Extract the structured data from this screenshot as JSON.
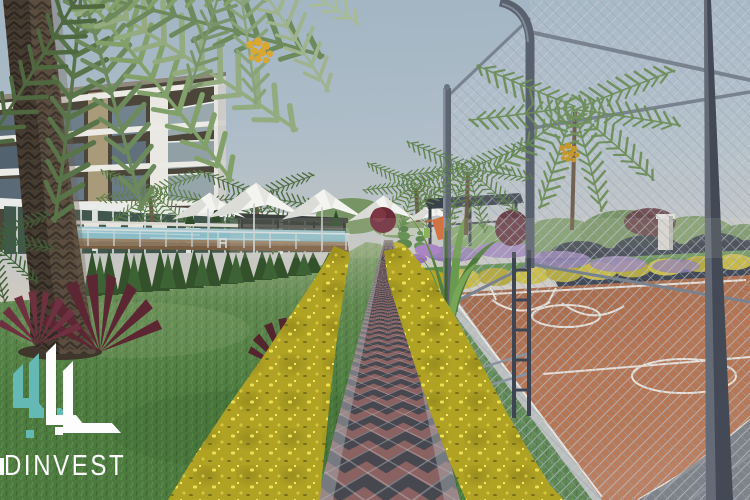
{
  "watermark": {
    "brand": "DINVEST"
  },
  "scene": {
    "description": "3D architectural rendering of a residential complex: apartment building with pool and canopy umbrellas on the left, a diamond-paved garden walkway lined with yellow flower hedges in the center, and a fenced basketball court with playground and pergola on the right."
  },
  "colors": {
    "sky_top": "#a2b5c3",
    "sky_horizon": "#dcd2c2",
    "lawn_green": "#4d7b3f",
    "walkway_slate": "#46474f",
    "walkway_mauve": "#8a6262",
    "flower_yellow": "#c9ba2f",
    "court_terracotta": "#b2673f",
    "court_line_white": "#f1eee8",
    "fence_gray": "#59616e",
    "pool_water": "#79b2bf",
    "hedge_green": "#3a5c33",
    "logo_teal": "#64b9b4",
    "logo_white": "#fdfdfd"
  }
}
